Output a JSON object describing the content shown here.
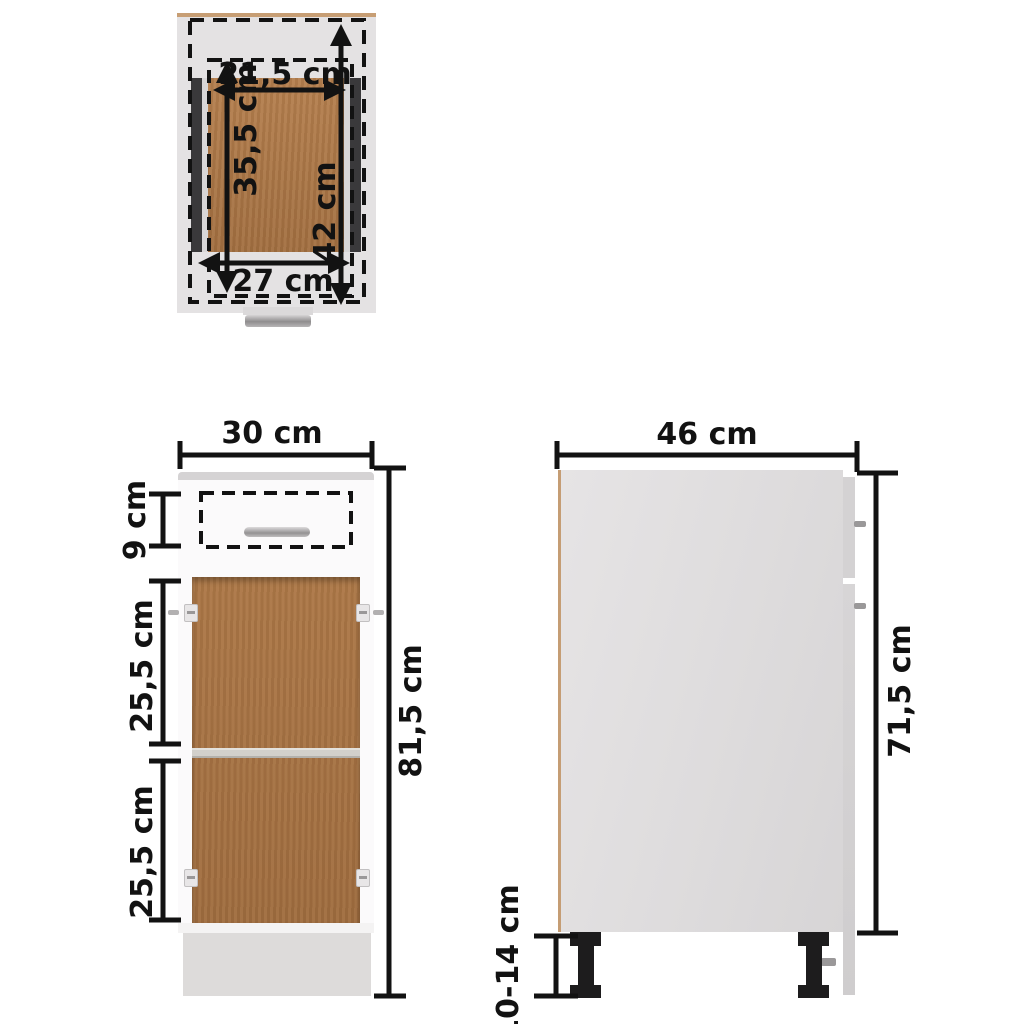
{
  "diagram_type": "furniture-dimension-drawing",
  "unit": "cm",
  "views": {
    "top": {
      "dims": {
        "inner_width": "21,5 cm",
        "inner_depth": "35,5 cm",
        "rail_depth": "42 cm",
        "drawer_width": "27 cm"
      }
    },
    "front": {
      "dims": {
        "width": "30 cm",
        "drawer_height": "9 cm",
        "upper_section": "25,5 cm",
        "lower_section": "25,5 cm",
        "total_height": "81,5 cm"
      }
    },
    "side": {
      "dims": {
        "depth": "46 cm",
        "body_height": "71,5 cm",
        "legs_height": "10-14 cm"
      }
    }
  },
  "colors": {
    "background": "#ffffff",
    "dimension_ink": "#121212",
    "cabinet_white": "#fbfafb",
    "top_surface_gray": "#e4e2e3",
    "panel_gray": "#dedcdd",
    "plinth_gray": "#dddbda",
    "wood_brown": "#a9743f",
    "wood_edge_tan": "#c79e74",
    "drawer_rail_dark": "#3a393b",
    "leg_black": "#1d1c1d",
    "handle_gray": "#949293"
  }
}
